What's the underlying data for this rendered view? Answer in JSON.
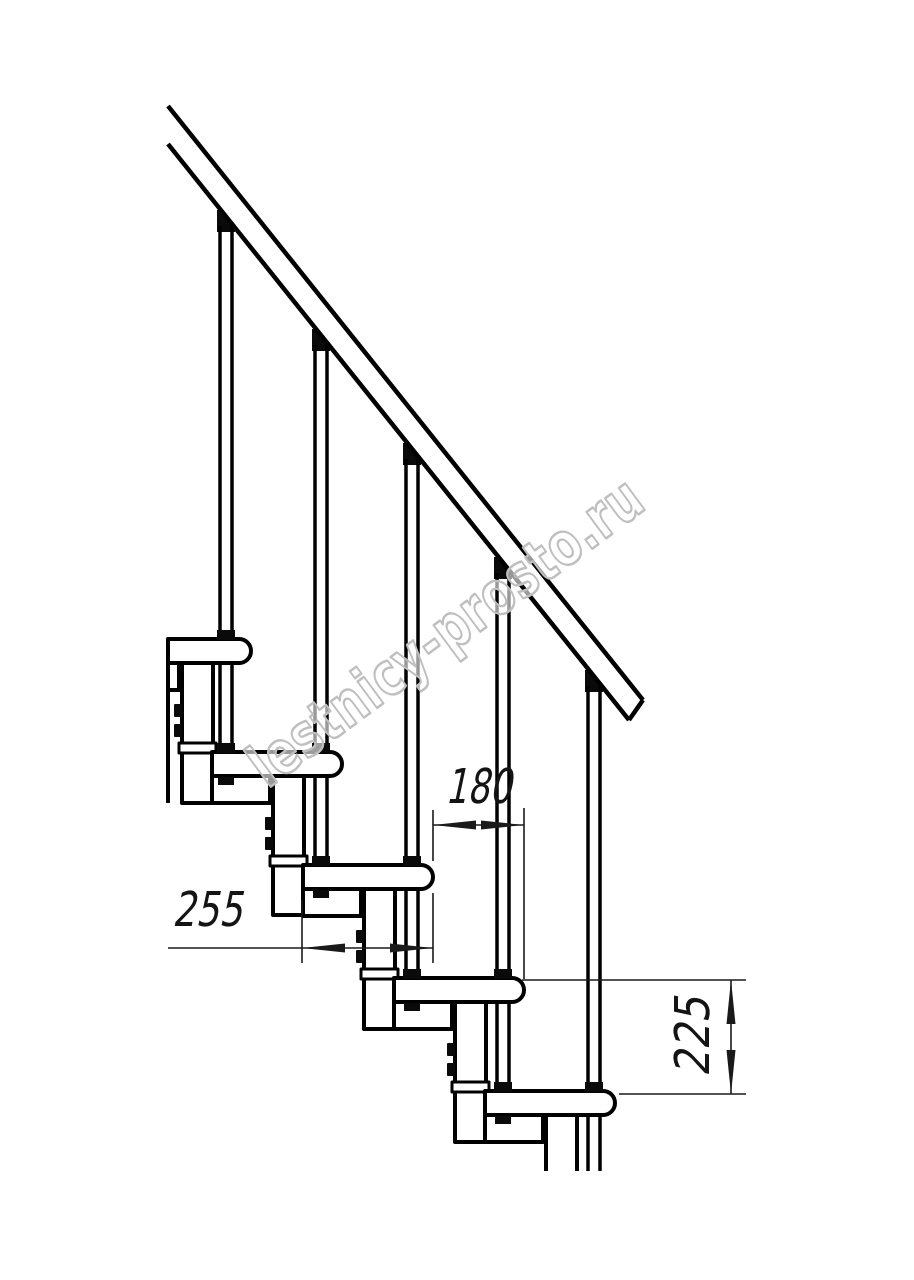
{
  "page": {
    "background": "#ffffff"
  },
  "drawing": {
    "subject": "modular-staircase-side-section",
    "watermark": "lestnicy-prosto.ru",
    "line_color": "#000000",
    "dimension_color": "#1a1a1a",
    "watermark_outline_color": "#bfbfbf",
    "dimensions": {
      "step_run": "180",
      "tread_depth": "255",
      "step_rise": "225"
    },
    "counts": {
      "treads": 5,
      "balusters": 5,
      "support_modules": 5
    }
  }
}
